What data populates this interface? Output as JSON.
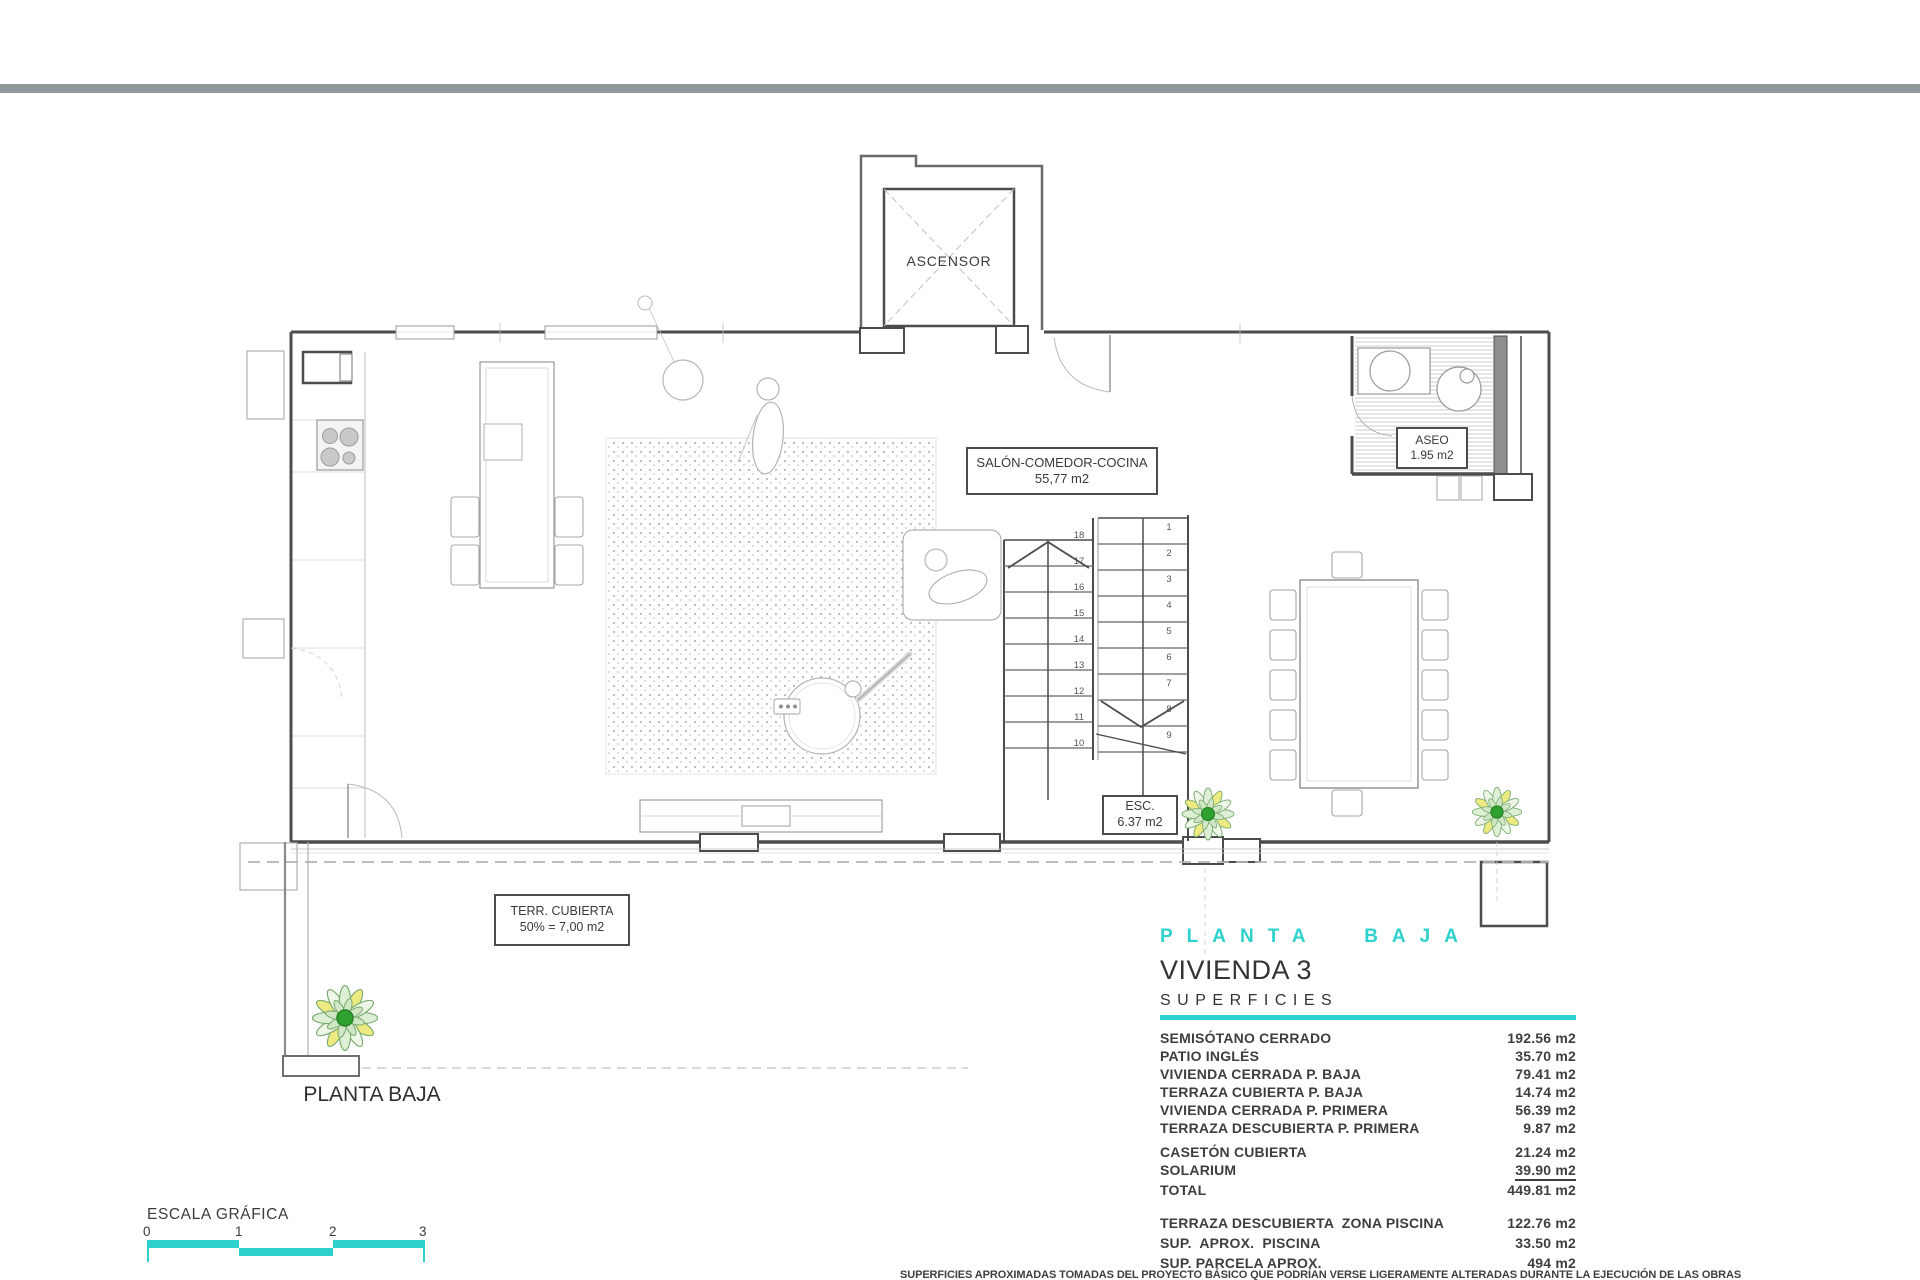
{
  "plan": {
    "room_labels": {
      "ascensor": "ASCENSOR",
      "salon_line1": "SALÓN-COMEDOR-COCINA",
      "salon_line2": "55,77 m2",
      "aseo_line1": "ASEO",
      "aseo_line2": "1.95 m2",
      "esc_line1": "ESC.",
      "esc_line2": "6.37 m2",
      "terraza_line1": "TERR. CUBIERTA",
      "terraza_line2": "50% = 7,00 m2",
      "floor_label": "PLANTA BAJA"
    },
    "stair_numbers": {
      "left_flight_top_to_bottom": [
        "18",
        "17",
        "16",
        "15",
        "14",
        "13",
        "12",
        "11",
        "10"
      ],
      "right_flight_top_to_bottom": [
        "1",
        "2",
        "3",
        "4",
        "5",
        "6",
        "7",
        "8",
        "9"
      ]
    }
  },
  "summary_panel": {
    "floor_heading": "PLANTA BAJA",
    "unit_title": "VIVIENDA 3",
    "section_title": "SUPERFICIES",
    "rows": [
      {
        "label": "SEMISÓTANO CERRADO",
        "value": "192.56 m2"
      },
      {
        "label": "PATIO INGLÉS",
        "value": "35.70 m2"
      },
      {
        "label": "VIVIENDA CERRADA P. BAJA",
        "value": "79.41 m2"
      },
      {
        "label": "TERRAZA CUBIERTA P. BAJA",
        "value": "14.74 m2"
      },
      {
        "label": "VIVIENDA CERRADA P. PRIMERA",
        "value": "56.39 m2"
      },
      {
        "label": "TERRAZA DESCUBIERTA P. PRIMERA",
        "value": "9.87 m2"
      },
      {
        "label": "CASETÓN CUBIERTA",
        "value": "21.24 m2",
        "gap_before": true
      },
      {
        "label": "SOLARIUM",
        "value": "39.90 m2",
        "underline": true
      },
      {
        "label": "TOTAL",
        "value": "449.81 m2"
      }
    ],
    "extra_rows": [
      {
        "label": "TERRAZA DESCUBIERTA  ZONA PISCINA",
        "value": "122.76 m2"
      },
      {
        "label": "SUP.  APROX.  PISCINA",
        "value": "33.50 m2"
      },
      {
        "label": "SUP. PARCELA APROX.",
        "value": "494 m2"
      }
    ]
  },
  "scale_bar": {
    "title": "ESCALA GRÁFICA",
    "tick_labels": [
      "0",
      "1",
      "2",
      "3"
    ]
  },
  "footer": {
    "disclaimer": "SUPERFICIES APROXIMADAS TOMADAS DEL PROYECTO BÁSICO QUE PODRÍAN VERSE LIGERAMENTE ALTERADAS DURANTE LA EJECUCIÓN DE LAS OBRAS"
  },
  "colors": {
    "accent_teal": "#2fd1cc",
    "wall_dark": "#4c4c4c",
    "topbar_gray": "#909899"
  }
}
